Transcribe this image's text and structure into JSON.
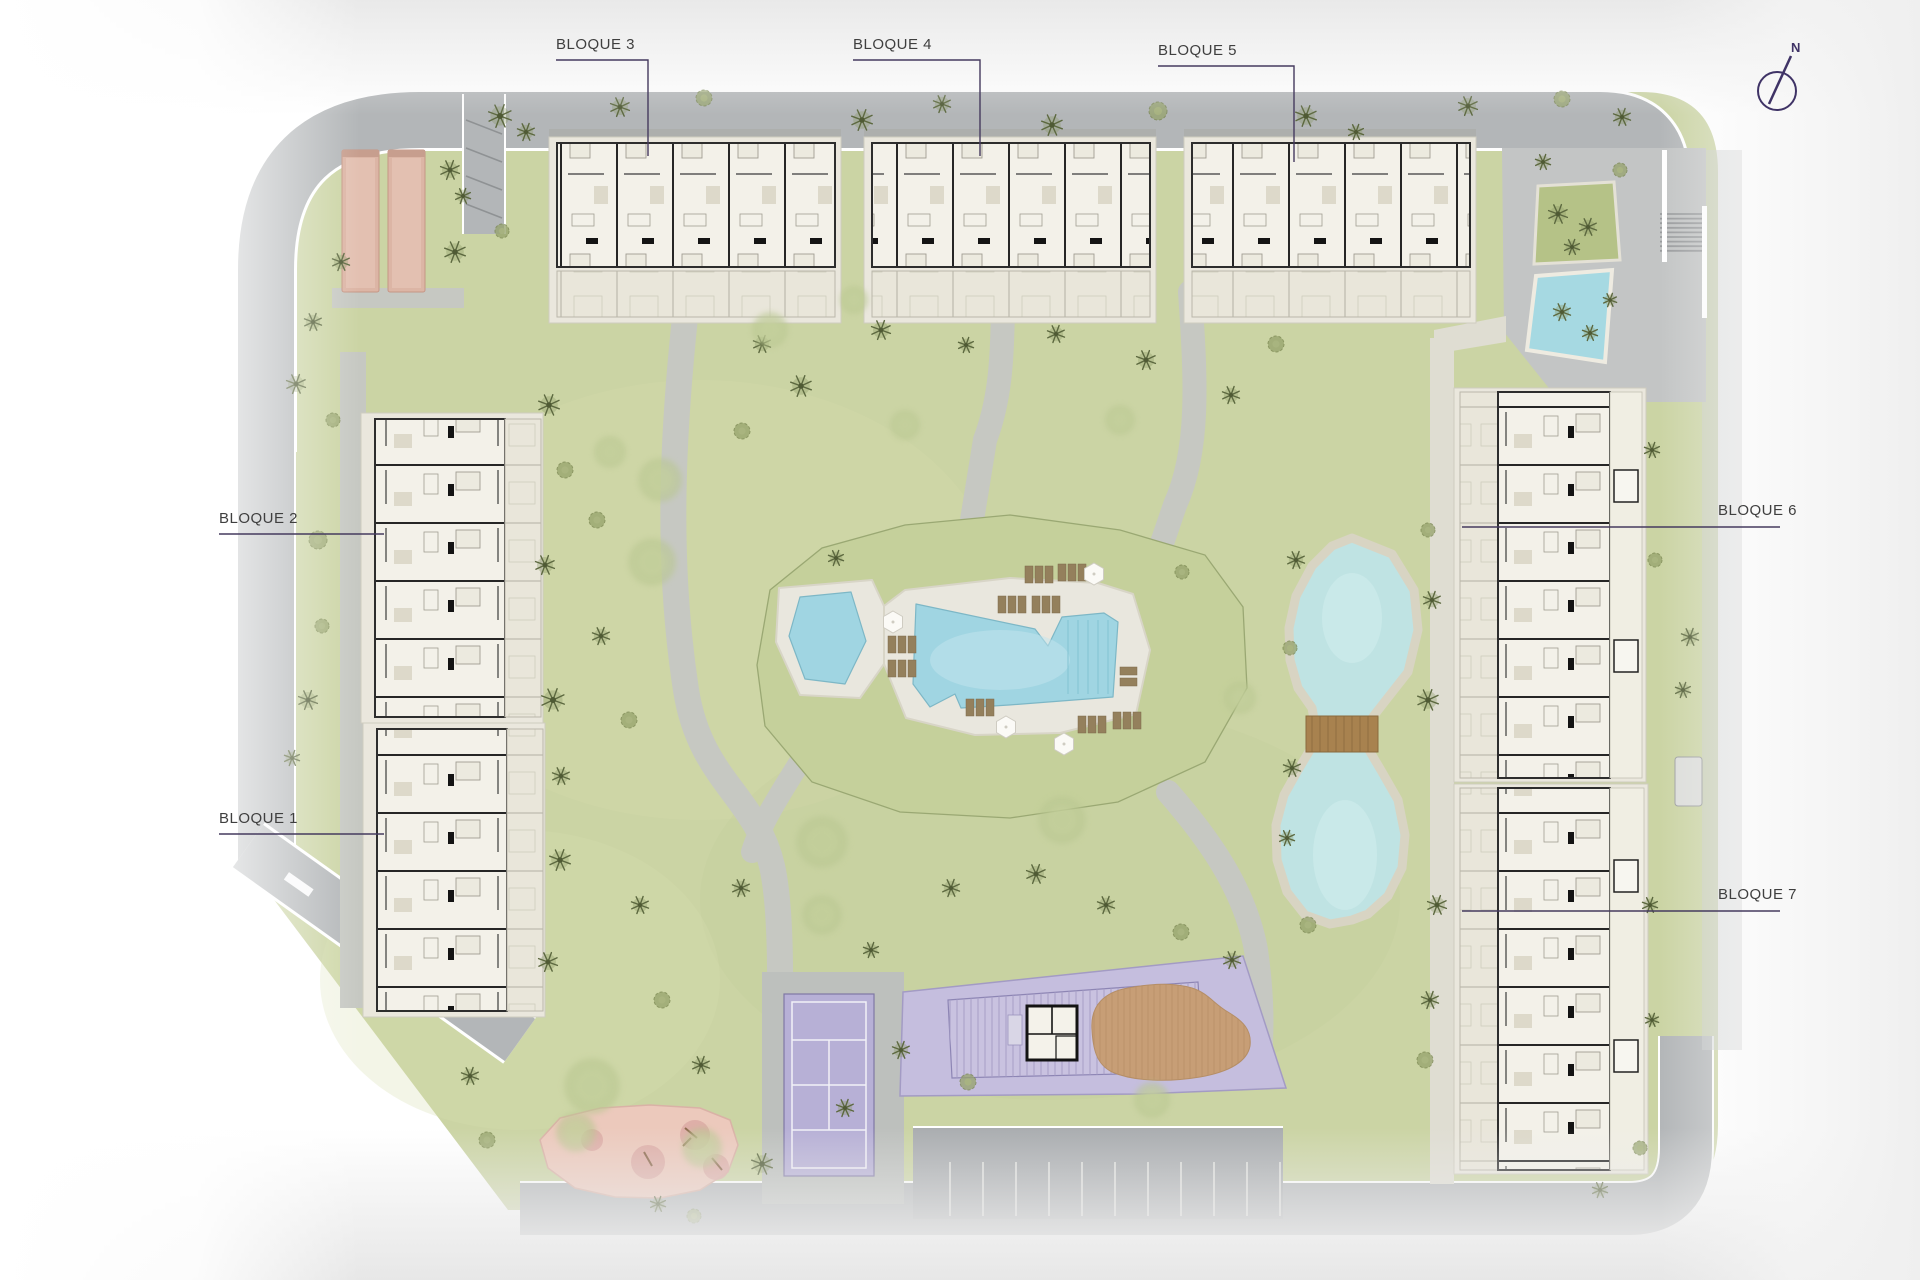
{
  "blocks": [
    {
      "id": "bloque-1",
      "label": "BLOQUE 1"
    },
    {
      "id": "bloque-2",
      "label": "BLOQUE 2"
    },
    {
      "id": "bloque-3",
      "label": "BLOQUE 3"
    },
    {
      "id": "bloque-4",
      "label": "BLOQUE 4"
    },
    {
      "id": "bloque-5",
      "label": "BLOQUE 5"
    },
    {
      "id": "bloque-6",
      "label": "BLOQUE 6"
    },
    {
      "id": "bloque-7",
      "label": "BLOQUE 7"
    }
  ],
  "compass": {
    "label": "N"
  },
  "colors": {
    "lawn": "#cbd4a4",
    "lawn_mound": "#c5d09b",
    "road": "#b3b6b8",
    "path": "#c6c8c2",
    "water_pool": "#a0d5e2",
    "water_lake": "#bfe3e3",
    "deck": "#e9e7de",
    "building_fill": "#f3f1e9",
    "building_wall": "#2d2d2d",
    "terrace": "#eae7dd",
    "purple_court": "#b7b0d6",
    "purple_deck": "#c5bede",
    "wood_deck": "#c79e76",
    "playground": "#ecc9bc",
    "petanque": "#dcb5a5",
    "label_line": "#453a5e",
    "label_text": "#3f3f3f",
    "compass": "#3f3366"
  }
}
